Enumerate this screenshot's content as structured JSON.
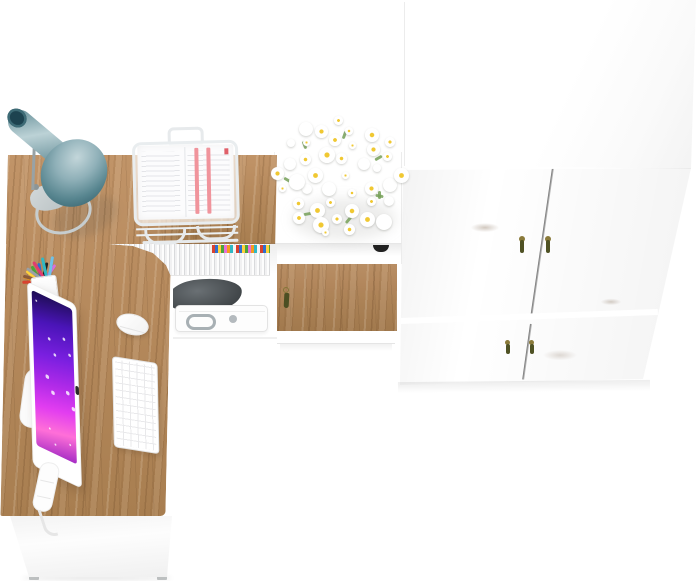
{
  "scene": {
    "title": "Home office furniture set - top view 3D render",
    "view": "top-down product render",
    "background_color": "#ffffff",
    "has_text": false
  },
  "palette": {
    "wood": "#b5895c",
    "wood_light": "#c19468",
    "wood_dark": "#8a6242",
    "seam": "#6e6e6e",
    "white_furniture": "#ffffff",
    "lamp_teal_light": "#bcd2d6",
    "lamp_teal": "#57858f",
    "lamp_teal_dark": "#2e5a66",
    "lamp_tip": "#1d4350",
    "lamp_base": "#c6cdcf",
    "screen_deep": "#1d0d52",
    "screen_purple": "#7a1fe0",
    "screen_magenta": "#e23df0",
    "screen_pink": "#ff6fd8",
    "bag": "#3f4447",
    "chrome": "#a8b0b4",
    "handle_bronze": "#8a7a3a",
    "handle_tassel": "#4f5224",
    "notch": "#222222",
    "flower_core": "#f0c832",
    "leaf_green": "#76a058"
  },
  "objects": {
    "desk": {
      "name": "L-shaped corner desk",
      "top_material": "oak",
      "front_material": "white",
      "feet": 2
    },
    "lamp": {
      "name": "cone desk lamp",
      "shade_color": "teal",
      "base": "gray ring"
    },
    "document_tray": {
      "name": "white wire document stand",
      "contents": "stacked papers with red stripes"
    },
    "pen_cup": {
      "name": "white pen cup",
      "contents": "assorted colored pens and pencils"
    },
    "monitor": {
      "name": "all-in-one computer",
      "body": "white",
      "wallpaper": "purple-magenta abstract"
    },
    "keyboard": {
      "name": "white compact keyboard"
    },
    "mouse": {
      "name": "white mouse"
    },
    "storage_compartment": {
      "magazines": "row of magazines with colorful spines",
      "bag": "dark gray pouch",
      "briefcase": "white case with chrome handle and round latch"
    },
    "cabinet": {
      "name": "white wall cabinet",
      "drawer_front": "oak with tassel pull",
      "open_slot_handle": "black notch",
      "decoration": "bouquet of white daisies"
    },
    "wardrobe": {
      "name": "two-section wardrobe",
      "top": "white",
      "doors": 4,
      "door_material": "oak",
      "handles": "bronze tassel pulls",
      "handle_count": 4
    }
  },
  "decor": {
    "pen_colors": [
      "#d8432f",
      "#f59b1e",
      "#ffd23d",
      "#4ba53c",
      "#2e6fd0",
      "#232323",
      "#d86fd8",
      "#8a5a3a",
      "#9aa0a6",
      "#e23c6f",
      "#30b8c4",
      "#6fc2e8"
    ],
    "magazine_spines": [
      "#d8422f",
      "#2f6fd0",
      "#ffd23d",
      "#4ba53c",
      "#e86fd8",
      "#f59b1e",
      "#2fb8c4",
      "#f5f5f5"
    ],
    "flower_count": 42,
    "leaf_count": 8,
    "sparkle_count": 12
  }
}
